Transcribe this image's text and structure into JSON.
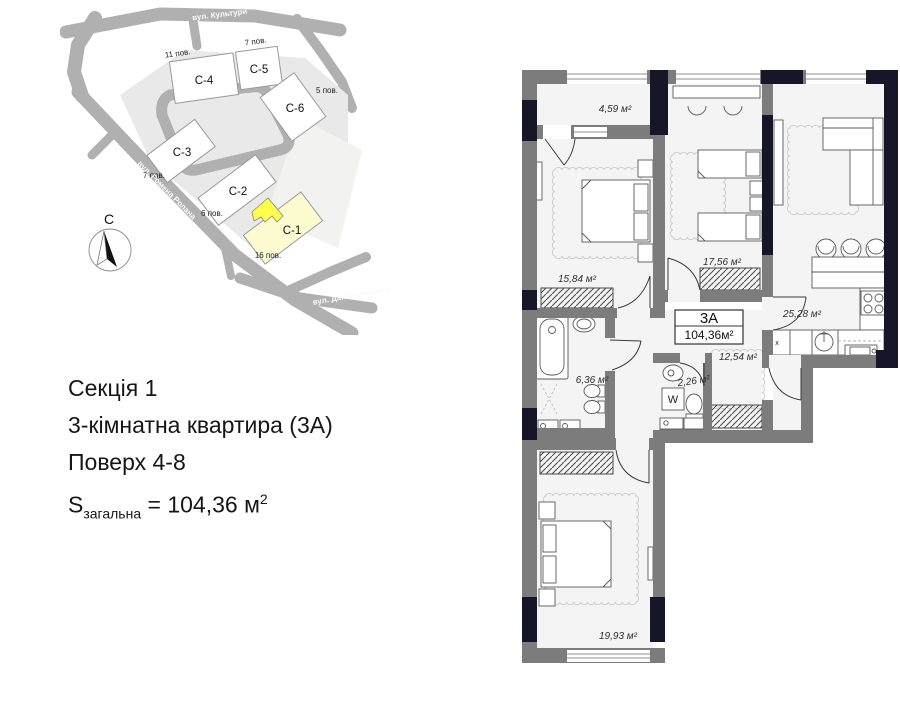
{
  "colors": {
    "wall": "#7c7c7c",
    "pier": "#161628",
    "room": "#f4f4f4",
    "road": "#b0b0b0",
    "site": "#e9e9e9",
    "highlight": "#ffff4a",
    "pale_building": "#fdfbd0"
  },
  "site_map": {
    "streets": {
      "top": "вул. Культури",
      "diagonal": "вул. Ромена Ролана",
      "bottom": "вул. Данилевського"
    },
    "buildings": [
      {
        "id": "С-4",
        "floors": "11 пов."
      },
      {
        "id": "С-5",
        "floors": "7 пов."
      },
      {
        "id": "С-6",
        "floors": "5 пов."
      },
      {
        "id": "С-3",
        "floors": "7 пов."
      },
      {
        "id": "С-2",
        "floors": "6 пов."
      },
      {
        "id": "С-1",
        "floors": "16 пов."
      }
    ],
    "compass_north": "С"
  },
  "info": {
    "line1": "Секція 1",
    "line2": "3-кімнатна квартира (3А)",
    "line3": "Поверх 4-8",
    "area_symbol": "S",
    "area_sub": "загальна",
    "area_eq": " = 104,36 м",
    "area_sup": "2"
  },
  "plan": {
    "unit": {
      "code": "3А",
      "area": "104,36м²"
    },
    "rooms": [
      {
        "name": "balcony",
        "area": "4,59 м²"
      },
      {
        "name": "bedroom-1",
        "area": "15,84 м²"
      },
      {
        "name": "children-room",
        "area": "17,56 м²"
      },
      {
        "name": "kitchen-living",
        "area": "25,28 м²"
      },
      {
        "name": "hallway",
        "area": "12,54 м²"
      },
      {
        "name": "bathroom",
        "area": "6,36 м²"
      },
      {
        "name": "wc",
        "area": "2,26 м²"
      },
      {
        "name": "bedroom-2",
        "area": "19,93 м²"
      }
    ],
    "washer_label": "W",
    "vent_label": "x"
  }
}
